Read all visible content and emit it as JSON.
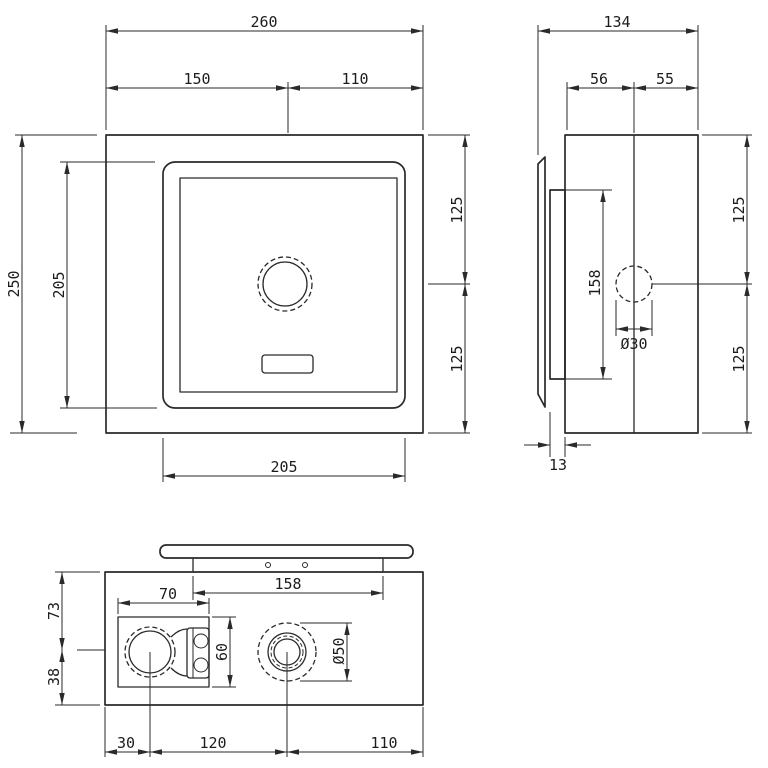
{
  "drawing": {
    "colors": {
      "line": "#2a2a2a",
      "background": "#ffffff"
    },
    "dimensions": {
      "front": {
        "total_width": "260",
        "sensor_offset_left": "150",
        "sensor_offset_right": "110",
        "total_height": "250",
        "plate_height": "205",
        "plate_width": "205",
        "sensor_to_top": "125",
        "sensor_to_bottom": "125"
      },
      "side": {
        "total_depth": "134",
        "depth_front": "56",
        "depth_back": "55",
        "mounting_height": "158",
        "hole_diameter": "Ø30",
        "wall_thickness": "13",
        "sensor_to_top": "125",
        "sensor_to_bottom": "125"
      },
      "bottom": {
        "flange_width": "158",
        "inlet_to_top": "73",
        "inlet_to_bottom": "38",
        "valve_width": "70",
        "valve_height": "60",
        "outlet_diameter": "Ø50",
        "edge_to_inlet": "30",
        "inlet_to_outlet": "120",
        "outlet_to_edge": "110"
      }
    }
  }
}
